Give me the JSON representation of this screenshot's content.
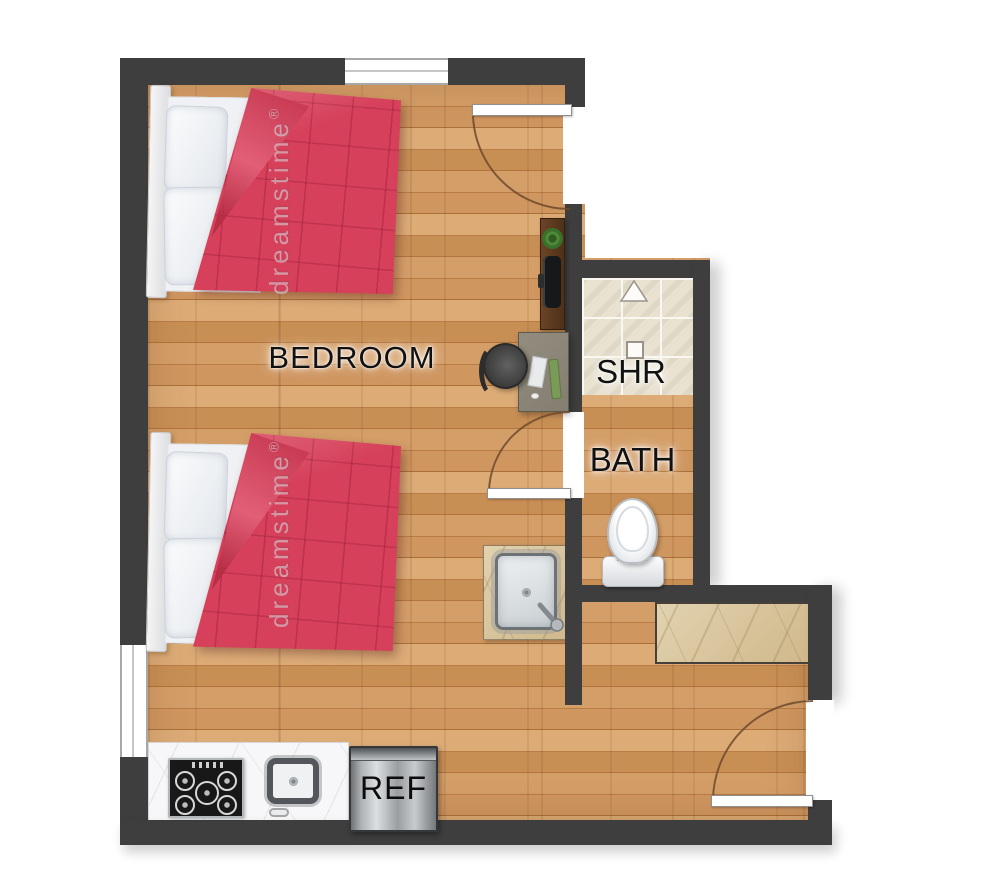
{
  "labels": {
    "bedroom": "BEDROOM",
    "shower": "SHR",
    "bath": "BATH",
    "refrigerator": "REF"
  },
  "watermark": {
    "text": "dreamstime",
    "reg": "®"
  },
  "rooms": [
    {
      "name": "bedroom",
      "label": "BEDROOM",
      "floor": "wood"
    },
    {
      "name": "shower",
      "label": "SHR",
      "floor": "tile"
    },
    {
      "name": "bath",
      "label": "BATH",
      "floor": "wood"
    },
    {
      "name": "kitchenette",
      "label": "",
      "floor": "wood"
    }
  ],
  "fixtures": [
    "bed-1",
    "bed-2",
    "desk",
    "desk-chair",
    "console-shelf",
    "plant",
    "monitor",
    "vanity-sink",
    "toilet",
    "shower-drain-square",
    "shower-triangle-marker",
    "stove",
    "kitchen-sink",
    "refrigerator",
    "side-counter",
    "entry-door",
    "bath-door",
    "patio-door",
    "window-top",
    "window-left"
  ],
  "colors": {
    "wall": "#3e3e3e",
    "wood_floor": "#c9935c",
    "shower_tile": "#e9e2d1",
    "counter_white_marble": "#f7f7f9",
    "counter_beige_marble": "#d8c49c",
    "comforter_red": "#d6405a",
    "door_arc": "#6f4a2c",
    "stainless": "#aeb2b5"
  }
}
